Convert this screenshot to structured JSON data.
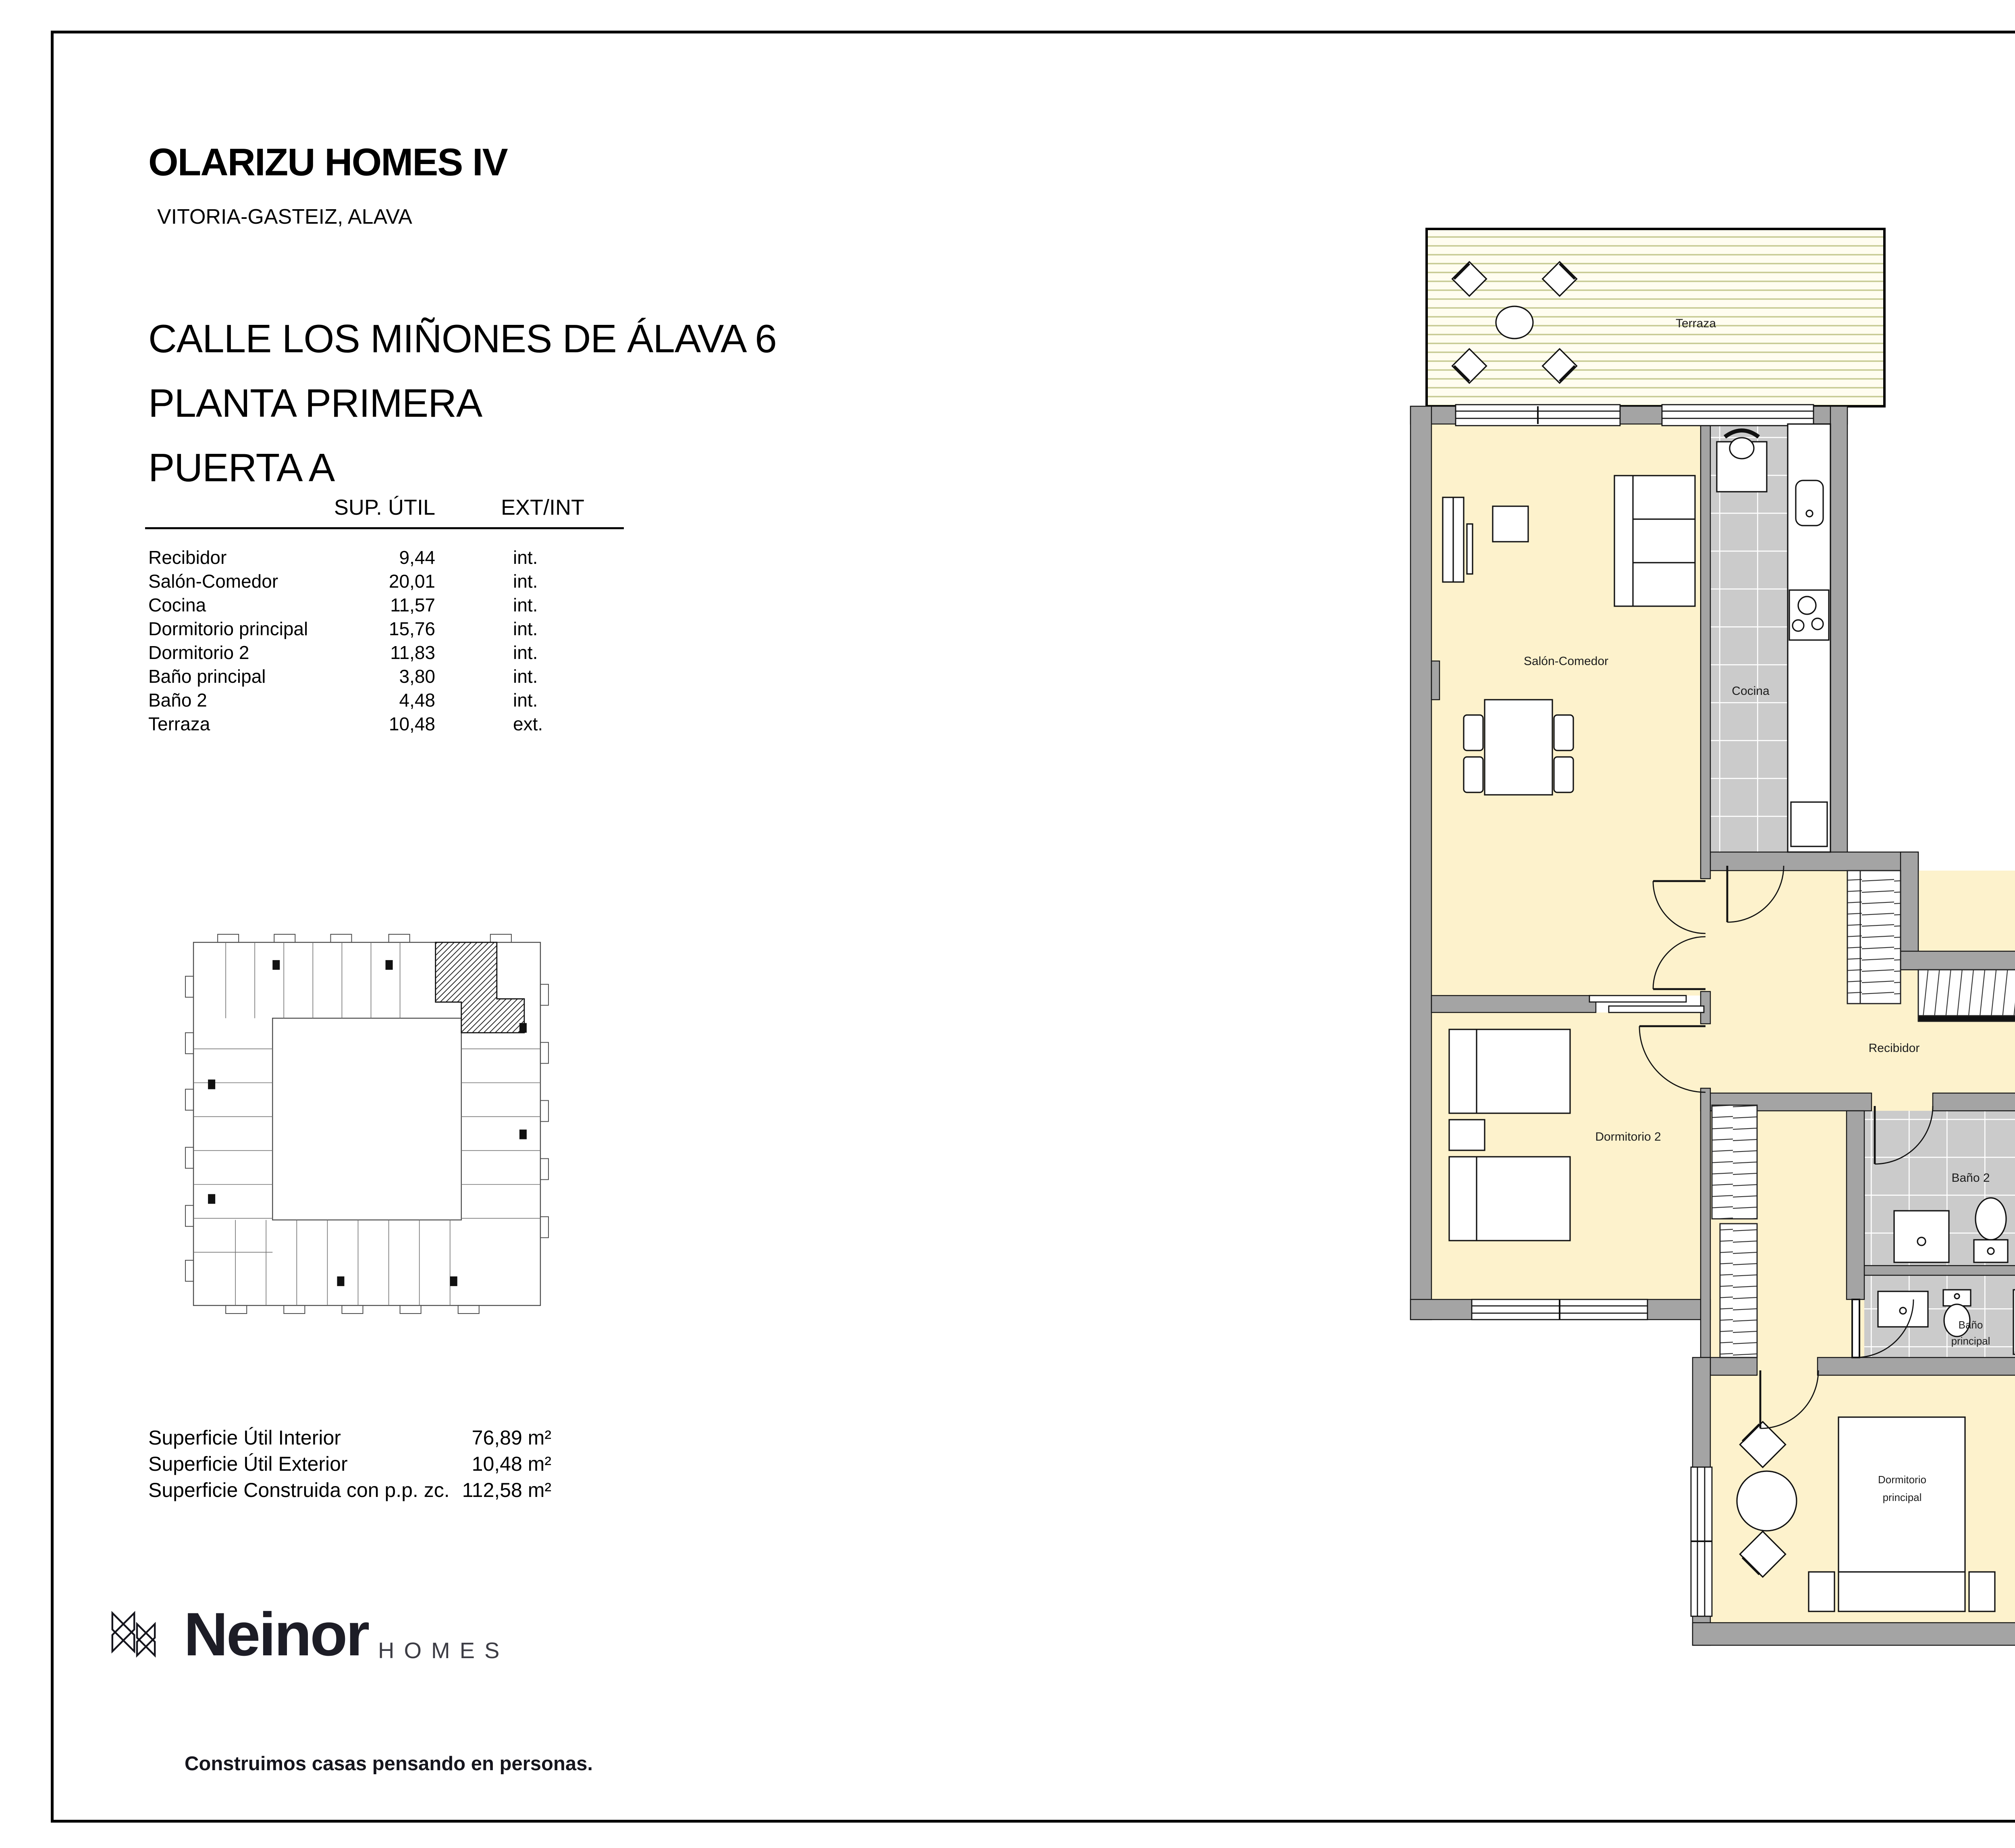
{
  "project": {
    "name": "OLARIZU HOMES IV",
    "location": "VITORIA-GASTEIZ, ALAVA"
  },
  "address": {
    "line1": "CALLE LOS MIÑONES DE ÁLAVA 6",
    "line2": "PLANTA PRIMERA",
    "line3": "PUERTA A"
  },
  "areas_table": {
    "col_sup": "SUP. ÚTIL",
    "col_ext": "EXT/INT",
    "rows": [
      {
        "room": "Recibidor",
        "sup": "9,44",
        "type": "int."
      },
      {
        "room": "Salón-Comedor",
        "sup": "20,01",
        "type": "int."
      },
      {
        "room": "Cocina",
        "sup": "11,57",
        "type": "int."
      },
      {
        "room": "Dormitorio principal",
        "sup": "15,76",
        "type": "int."
      },
      {
        "room": "Dormitorio 2",
        "sup": "11,83",
        "type": "int."
      },
      {
        "room": "Baño principal",
        "sup": "3,80",
        "type": "int."
      },
      {
        "room": "Baño 2",
        "sup": "4,48",
        "type": "int."
      },
      {
        "room": "Terraza",
        "sup": "10,48",
        "type": "ext."
      }
    ]
  },
  "totals": {
    "rows": [
      {
        "label": "Superficie Útil Interior",
        "value": "76,89 m²"
      },
      {
        "label": "Superficie Útil Exterior",
        "value": "10,48 m²"
      },
      {
        "label": "Superficie Construida con p.p. zc.",
        "value": "112,58 m²"
      }
    ]
  },
  "plan_labels": {
    "terraza": "Terraza",
    "salon": "Salón-Comedor",
    "cocina": "Cocina",
    "recibidor": "Recibidor",
    "dorm2": "Dormitorio 2",
    "bano2": "Baño 2",
    "bano_principal_l1": "Baño",
    "bano_principal_l2": "principal",
    "dorm_principal_l1": "Dormitorio",
    "dorm_principal_l2": "principal"
  },
  "titleblock": {
    "date": "NOV. 2024",
    "scale_label": "ESCALA GRÁFICA",
    "ticks": [
      "0",
      "1",
      "2",
      "3m"
    ]
  },
  "brand": {
    "name": "Neinor",
    "sub": "HOMES",
    "tagline": "Construimos casas pensando en personas."
  },
  "colors": {
    "room_cream": "#fdf2cc",
    "tile_gray": "#cbcbcb",
    "wall_gray": "#a4a4a4",
    "deck_line_olive": "#c6ca92",
    "arrow_gray": "#8f8f8f"
  }
}
